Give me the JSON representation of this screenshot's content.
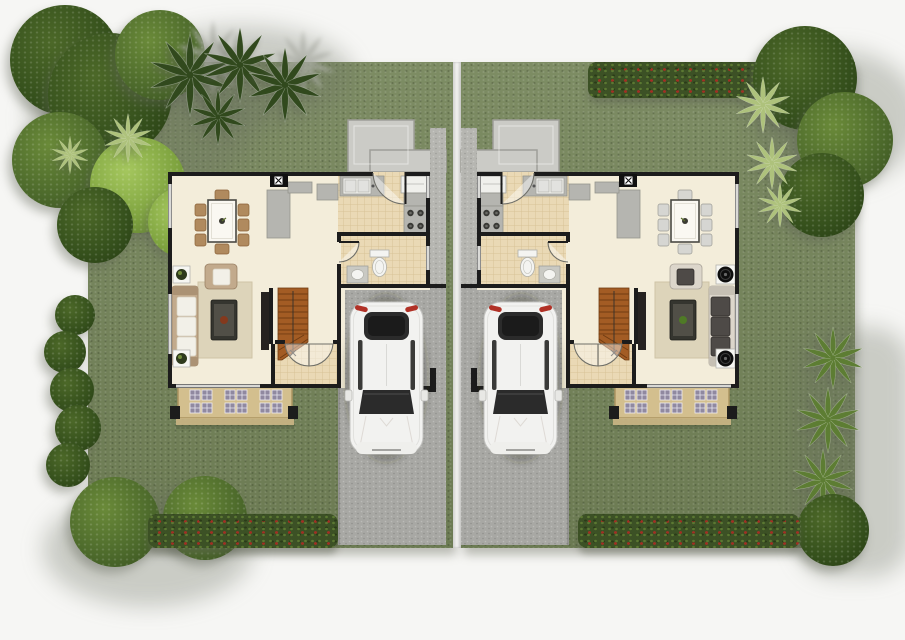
{
  "scene": {
    "type": "floor-plan",
    "view": "top-down architectural 3D rendering",
    "description": "Two mirrored duplex house lots separated by a white boundary strip; each lot has a single-storey floor plan, landscaped garden, concrete driveway and a white sedan parked beside the house",
    "lot_count": 2,
    "visible_text": "none"
  },
  "colors": {
    "page": "#f6f6f4",
    "divider": "#f3f3f1",
    "lawn": "#75855a",
    "wall": "#1c1c1c",
    "floor": "#f3edda",
    "tileFill": "#ead9b5",
    "tileLine": "#d8c397",
    "drive": "#a8a8a4",
    "walkway": "#b6b6b1",
    "pad": "#cbcbc6",
    "padEdge": "#9e9e98",
    "porch": "#d3bf8e",
    "porchEdge": "#ab9461",
    "paver": "#9089a0",
    "stairs": "#a35c24",
    "stairsDark": "#713c12",
    "rug": "#ddd4ba",
    "sofa": "#c2aa8c",
    "sofaArm": "#ab9274",
    "cushion": "#f2f0e8",
    "sofaGray": "#dcd6cb",
    "pillowDark": "#4e4a47",
    "tvDark": "#262220",
    "chair": "#b08a5e",
    "chairEdge": "#8a6238",
    "counter": "#b5b5b0",
    "counterEdge": "#94948d",
    "appliance": "#f0f0ec",
    "ctDark": "#35352f",
    "ctInner": "#514f47",
    "ctDotLeft": "#84391d",
    "ctDotRight": "#4f7a26",
    "hedge": "#3c5125",
    "hedgeDot": "#5b7832",
    "flower": "#a03024",
    "treeDark": "#35501c",
    "treeDarkHi": "#4c6828",
    "treeMid": "#4c692b",
    "treeMidHi": "#6a8a39",
    "treeLight": "#7da23e",
    "treeLightHi": "#a5c75e",
    "palm": "#aec27c",
    "palm2": "#5d7d33",
    "fern": "#31491d",
    "carBody": "#f2f2f0",
    "carGlass": "#2b2b2b",
    "carGlassDark": "#1b1b1b",
    "carTail": "#b13126"
  },
  "lot_left": {
    "label": "left unit",
    "house": {
      "rooms": [
        {
          "name": "dining-area",
          "items": [
            "rectangular dining table",
            "8 wooden chairs",
            "storage column",
            "sideboard blocks"
          ]
        },
        {
          "name": "kitchen",
          "items": [
            "double-basin sink counter",
            "refrigerator",
            "4-burner stove",
            "rear service door",
            "wall panel with x marker"
          ]
        },
        {
          "name": "bathroom",
          "items": [
            "toilet",
            "vanity sink",
            "swing door"
          ]
        },
        {
          "name": "living-room",
          "items": [
            "three-seat tan sofa with white cushions",
            "armchair",
            "dark coffee table with red centerpiece",
            "area rug",
            "tv console",
            "2 white plant side tables"
          ]
        },
        {
          "name": "staircase",
          "items": [
            "wooden straight stair with lower winders",
            "direction line"
          ]
        },
        {
          "name": "entry-foyer",
          "items": [
            "double entry doors",
            "square tiled floor"
          ]
        }
      ],
      "outdoor": [
        "rear concrete service pad",
        "side walkway",
        "front porch with lattice pavers",
        "carport driveway"
      ]
    },
    "car": {
      "type": "sedan",
      "color": "white",
      "heading": "front toward street (bottom)"
    },
    "garden": [
      "dense tree grove top-left corner",
      "fern fronds along top edge",
      "light round tree",
      "shrub row on left edge",
      "two round bushes bottom-left",
      "red flowering hedge along bottom"
    ]
  },
  "lot_right": {
    "label": "right unit (mirrored plan)",
    "house": {
      "rooms": [
        {
          "name": "dining-area",
          "items": [
            "rectangular dining table",
            "8 light-gray chairs",
            "storage column",
            "console with flower arrangement"
          ]
        },
        {
          "name": "kitchen",
          "items": [
            "double-basin sink counter",
            "refrigerator",
            "4-burner stove",
            "rear service door",
            "wall panel with x marker"
          ]
        },
        {
          "name": "bathroom",
          "items": [
            "toilet",
            "vanity sink",
            "swing door"
          ]
        },
        {
          "name": "living-room",
          "items": [
            "light sofa with dark patterned cushions",
            "armchair with patterned pillow",
            "black coffee table with green plant",
            "area rug",
            "tv console",
            "2 round floor speakers on white stands"
          ]
        },
        {
          "name": "staircase",
          "items": [
            "wooden straight stair with lower winders",
            "direction line"
          ]
        },
        {
          "name": "entry-foyer",
          "items": [
            "double entry doors",
            "square tiled floor"
          ]
        }
      ],
      "outdoor": [
        "rear concrete service pad",
        "side walkway",
        "front porch with lattice pavers",
        "carport driveway"
      ]
    },
    "car": {
      "type": "sedan",
      "color": "white",
      "heading": "front toward street (bottom)"
    },
    "garden": [
      "red flowering hedge along top",
      "tree grove top-right corner",
      "striped palm cluster top-right",
      "palm row along right edge",
      "round bush bottom-right corner",
      "red flowering hedge along bottom"
    ]
  }
}
